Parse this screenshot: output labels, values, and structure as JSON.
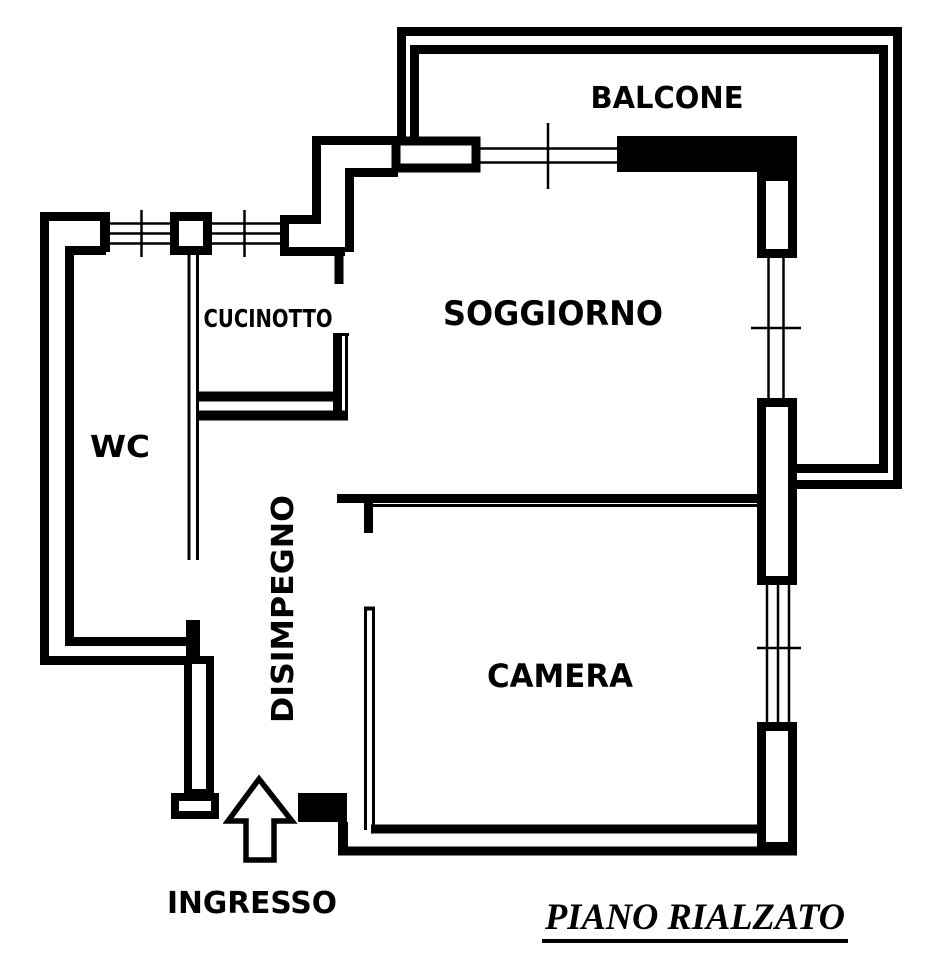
{
  "plan_title": "PIANO RIALZATO",
  "labels": {
    "balcone": "BALCONE",
    "cucinotto": "CUCINOTTO",
    "soggiorno": "SOGGIORNO",
    "wc": "WC",
    "disimpegno": "DISIMPEGNO",
    "camera": "CAMERA",
    "ingresso": "INGRESSO"
  },
  "entrance": {
    "symbol": "up-arrow",
    "meaning": "entrance direction"
  },
  "colors": {
    "walls": "#000000",
    "background": "#ffffff",
    "text": "#000000"
  }
}
